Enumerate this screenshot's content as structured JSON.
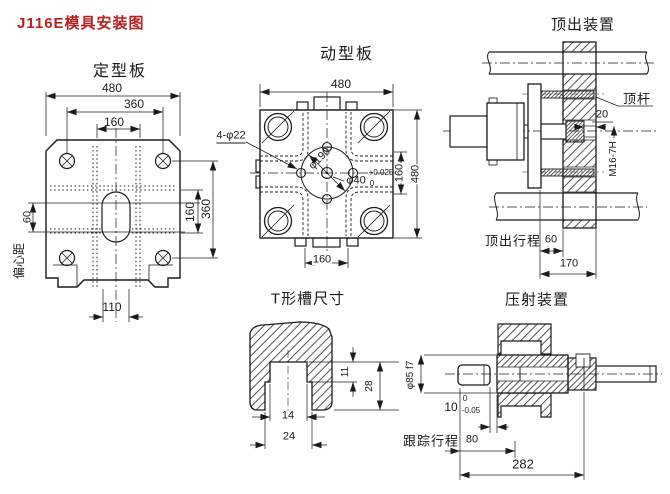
{
  "title": "J116E模具安装图",
  "fixed_platen": {
    "label": "定型板",
    "dim_top_480": "480",
    "dim_top_360": "360",
    "dim_top_160": "160",
    "dim_right_160": "160",
    "dim_right_360": "360",
    "dim_offset_60": "60",
    "offset_label": "偏心距",
    "dim_bottom_110": "110"
  },
  "moving_platen": {
    "label": "动型板",
    "dim_top_480": "480",
    "holes_label": "4-φ22",
    "bolt_circle_dia": "φ190",
    "center_hole_dia": "φ40",
    "center_tol_upper": "+0.025",
    "center_tol_lower": "0",
    "dim_right_160": "160",
    "dim_right_480": "480",
    "dim_bottom_160": "160"
  },
  "ejector_unit": {
    "label": "顶出装置",
    "rod_label": "顶杆",
    "dim_20": "20",
    "thread_spec": "M16-7H",
    "stroke_label": "顶出行程",
    "stroke_value": "60",
    "dim_170": "170"
  },
  "t_slot": {
    "label": "T形槽尺寸",
    "dim_11": "11",
    "dim_28": "28",
    "dim_14": "14",
    "dim_24": "24"
  },
  "injection_unit": {
    "label": "压射装置",
    "plunger_dia": "φ85 f7",
    "dim_10": "10",
    "tol_upper": "0",
    "tol_lower": "-0.05",
    "stroke_label": "跟踪行程",
    "stroke_value": "80",
    "dim_282": "282"
  },
  "colors": {
    "title_red": "#b42222",
    "line": "#1b1b1b"
  }
}
